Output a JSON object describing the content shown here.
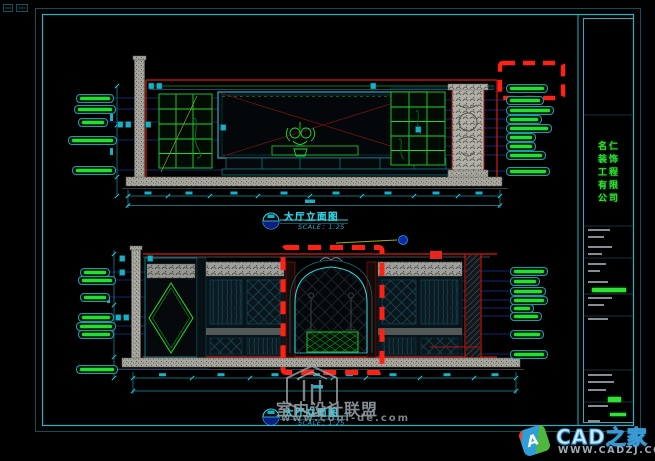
{
  "colors": {
    "background": "#000000",
    "frame_outer": "#0a525c",
    "frame_inner": "#1fb4c4",
    "red": "#e8241f",
    "green": "#21e02f",
    "teal": "#1796a8",
    "leader_blue": "#16379b",
    "cyan_text": "#38d6e8",
    "gray": "#99a0a8"
  },
  "upper_drawing": {
    "title": "大厅立面图",
    "scale": "SCALE：1:25",
    "left_labels": [
      {
        "x": 76,
        "y": 94,
        "w": 36
      },
      {
        "x": 74,
        "y": 105,
        "w": 40
      },
      {
        "x": 78,
        "y": 118,
        "w": 28
      },
      {
        "x": 68,
        "y": 136,
        "w": 47
      },
      {
        "x": 72,
        "y": 166,
        "w": 42
      }
    ],
    "right_labels": [
      {
        "x": 506,
        "y": 84,
        "w": 40
      },
      {
        "x": 506,
        "y": 96,
        "w": 36
      },
      {
        "x": 506,
        "y": 106,
        "w": 46
      },
      {
        "x": 506,
        "y": 115,
        "w": 34
      },
      {
        "x": 506,
        "y": 124,
        "w": 44
      },
      {
        "x": 506,
        "y": 133,
        "w": 28
      },
      {
        "x": 506,
        "y": 142,
        "w": 28
      },
      {
        "x": 506,
        "y": 151,
        "w": 38
      },
      {
        "x": 506,
        "y": 167,
        "w": 42
      }
    ]
  },
  "lower_drawing": {
    "title": "大厅立面图",
    "scale": "SCALE：1:25",
    "left_labels": [
      {
        "x": 80,
        "y": 268,
        "w": 28
      },
      {
        "x": 78,
        "y": 276,
        "w": 36
      },
      {
        "x": 80,
        "y": 293,
        "w": 28
      },
      {
        "x": 78,
        "y": 313,
        "w": 34
      },
      {
        "x": 76,
        "y": 322,
        "w": 38
      },
      {
        "x": 78,
        "y": 330,
        "w": 34
      },
      {
        "x": 76,
        "y": 365,
        "w": 40
      }
    ],
    "right_labels": [
      {
        "x": 510,
        "y": 267,
        "w": 36
      },
      {
        "x": 510,
        "y": 277,
        "w": 28
      },
      {
        "x": 510,
        "y": 287,
        "w": 34
      },
      {
        "x": 510,
        "y": 296,
        "w": 36
      },
      {
        "x": 510,
        "y": 304,
        "w": 22
      },
      {
        "x": 510,
        "y": 312,
        "w": 30
      },
      {
        "x": 510,
        "y": 330,
        "w": 32
      },
      {
        "x": 510,
        "y": 350,
        "w": 36
      }
    ]
  },
  "titleblock": {
    "company_chars": [
      "名仁",
      "装饰",
      "工程",
      "有限",
      "公司"
    ],
    "rows": [
      {
        "y": 229,
        "w": 22,
        "c": "gray"
      },
      {
        "y": 236,
        "w": 16,
        "c": "gray"
      },
      {
        "y": 246,
        "w": 24,
        "c": "gray"
      },
      {
        "y": 253,
        "w": 14,
        "c": "gray"
      },
      {
        "y": 263,
        "w": 18,
        "c": "gray"
      },
      {
        "y": 270,
        "w": 12,
        "c": "gray"
      },
      {
        "y": 281,
        "w": 20,
        "c": "gray"
      },
      {
        "y": 288,
        "w": 34,
        "c": "green",
        "h": 4,
        "x": 592
      },
      {
        "y": 297,
        "w": 24,
        "c": "gray"
      },
      {
        "y": 304,
        "w": 16,
        "c": "gray"
      },
      {
        "y": 318,
        "w": 20,
        "c": "gray"
      },
      {
        "y": 374,
        "w": 24,
        "c": "gray"
      },
      {
        "y": 381,
        "w": 26,
        "c": "gray"
      },
      {
        "y": 389,
        "w": 18,
        "c": "gray"
      },
      {
        "y": 397,
        "w": 13,
        "c": "green",
        "h": 5,
        "x": 608
      },
      {
        "y": 405,
        "w": 20,
        "c": "gray"
      },
      {
        "y": 413,
        "w": 16,
        "c": "green",
        "h": 3,
        "x": 610
      },
      {
        "y": 420,
        "w": 12,
        "c": "gray"
      }
    ]
  },
  "watermark": {
    "site_name": "室内设计联盟",
    "site_url": "www.cool-de.com"
  },
  "footer_logo": {
    "brand": "CAD之家",
    "url": "WWW.CADZJ.COM",
    "badge_letter": "A"
  }
}
